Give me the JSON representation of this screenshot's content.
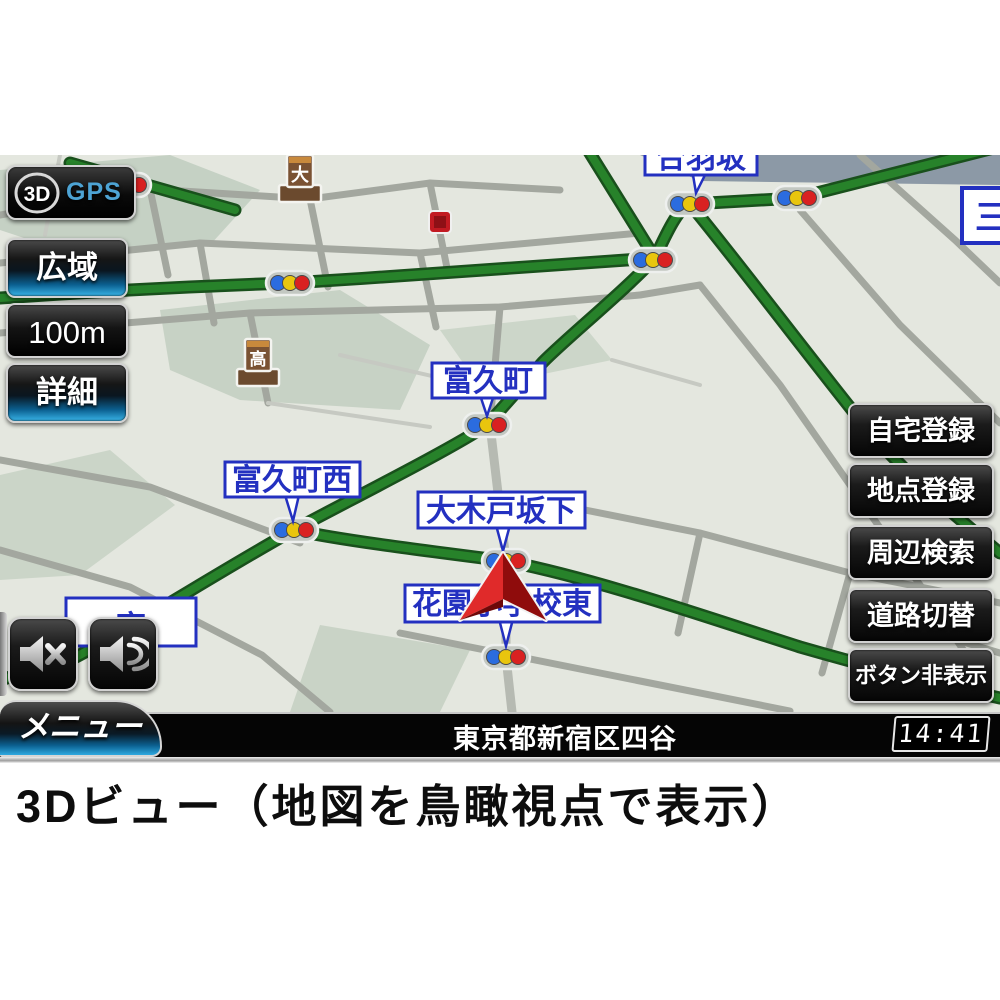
{
  "nav_screen": {
    "mode_panel": {
      "badge": "3D",
      "gps": "GPS"
    },
    "scale_buttons": [
      {
        "label": "広域"
      },
      {
        "label": "100m"
      },
      {
        "label": "詳細"
      }
    ],
    "action_buttons": [
      {
        "label": "自宅登録"
      },
      {
        "label": "地点登録"
      },
      {
        "label": "周辺検索"
      },
      {
        "label": "道路切替"
      },
      {
        "label": "ボタン非表示"
      }
    ],
    "audio_buttons": [
      {
        "icon": "speaker-mute-icon"
      },
      {
        "icon": "speaker-on-icon"
      }
    ],
    "menu_button": "メニュー",
    "status_bar": {
      "address": "東京都新宿区四谷",
      "time": "14:41"
    },
    "map": {
      "intersection_labels": [
        {
          "text": "富久町"
        },
        {
          "text": "富久町西"
        },
        {
          "text": "大木戸坂下"
        },
        {
          "text": "花園小学校東"
        },
        {
          "text": "合羽坂",
          "note": "partially visible at top edge"
        },
        {
          "text": "三",
          "note": "partially visible at right edge"
        },
        {
          "text": "育",
          "note": "mostly hidden behind audio buttons"
        }
      ],
      "poi_markers": [
        {
          "text": "大"
        },
        {
          "text": "高"
        }
      ],
      "colors": {
        "route_green": "#27822a",
        "signal_blue": "#2b6cdf",
        "signal_yellow": "#e9c50e",
        "signal_red": "#d92121",
        "label_blue": "#2330c0",
        "position_arrow_red": "#d61616"
      }
    }
  },
  "caption": "3Dビュー（地図を鳥瞰視点で表示）"
}
